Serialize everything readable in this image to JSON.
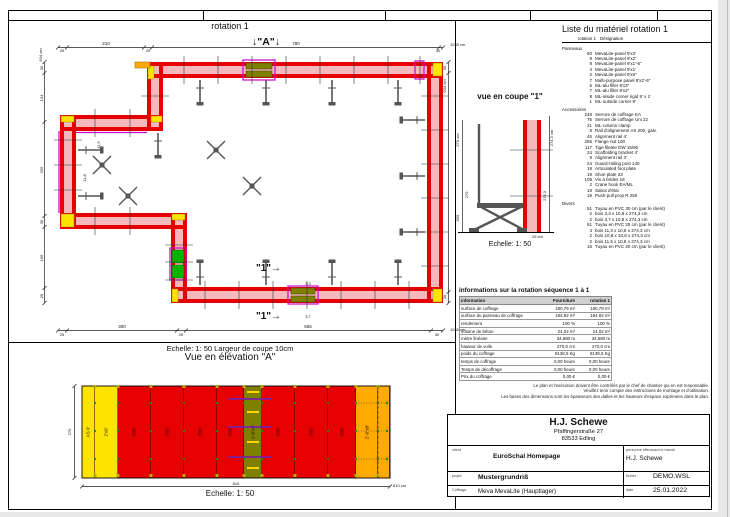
{
  "plan": {
    "title": "rotation 1",
    "marker_a": "↓\"A\"↓",
    "marker_1": "\"1\"→",
    "dims_top": [
      "25",
      "210",
      "20",
      "780",
      "30"
    ],
    "dims_top_total": "1045 cm",
    "dims_bottom": [
      "25",
      "300",
      "25",
      "665",
      "30"
    ],
    "dims_bottom_total": "1045 cm",
    "dims_left": [
      "30",
      "134",
      "255",
      "30",
      "166",
      "25"
    ],
    "dims_left_total": "604 cm",
    "dims_right": [
      "30",
      "30"
    ],
    "dims_right_total": "604 cm",
    "fillers": [
      "11,5",
      "11,8",
      "3,3",
      "3,7"
    ],
    "scale_note": "Echelle: 1: 50   Largeur de coupe 10cm"
  },
  "elevation": {
    "title": "Vue en élévation \"A\"",
    "dim_height": "270",
    "dim_width": "810",
    "dim_width_total": "810 cm",
    "scale": "Echelle: 1: 50",
    "panels": [
      {
        "label": "AS 9'",
        "color": "#ffe400",
        "w": 13
      },
      {
        "label": "2'x9'",
        "color": "#ffe400",
        "w": 23
      },
      {
        "label": "3'x9'",
        "color": "#e60000",
        "w": 33
      },
      {
        "label": "3'x9'",
        "color": "#e60000",
        "w": 33
      },
      {
        "label": "3'x9'",
        "color": "#e60000",
        "w": 33
      },
      {
        "label": "3'x9'",
        "color": "#e60000",
        "w": 27
      },
      {
        "label": "1'-6\"x9'",
        "color": "#7f7f00",
        "w": 18
      },
      {
        "label": "3'x9'",
        "color": "#e60000",
        "w": 33
      },
      {
        "label": "3'x9'",
        "color": "#e60000",
        "w": 33
      },
      {
        "label": "3'x9'",
        "color": "#e60000",
        "w": 28
      },
      {
        "label": "2'-6\"x9'",
        "color": "#ffaa00",
        "w": 22
      },
      {
        "label": "",
        "color": "#ffaa00",
        "w": 12
      }
    ]
  },
  "section": {
    "title": "vue en coupe \"1\"",
    "dim_left_cm": "270 cm",
    "dim_left": "270",
    "dim_left2": "609",
    "dim_right_cm": "274,3 cm",
    "dim_right": "274,3",
    "dim_bottom": "25 cm",
    "scale": "Echelle: 1: 50"
  },
  "material_list": {
    "title": "Liste du matériel  rotation 1",
    "col_qty": "rotation 1",
    "col_name": "Désignation",
    "groups": [
      {
        "name": "Panneaux",
        "items": [
          {
            "qty": "50",
            "name": "MevaLite-panel 9'x3'"
          },
          {
            "qty": "9",
            "name": "MevaLite-panel 9'x2'"
          },
          {
            "qty": "8",
            "name": "MevaLite-panel 9'x1'-6\""
          },
          {
            "qty": "4",
            "name": "MevaLite-panel 9'x1'"
          },
          {
            "qty": "2",
            "name": "MevaLite-panel 9'x6\""
          },
          {
            "qty": "7",
            "name": "Multi-purpose panel 9'x2'-6\""
          },
          {
            "qty": "5",
            "name": "ML-alu filler 9'x3\""
          },
          {
            "qty": "7",
            "name": "ML-alu filler 9'x2\""
          },
          {
            "qty": "8",
            "name": "ML-inside corner rigid 9' x 1'"
          },
          {
            "qty": "1",
            "name": "ML-outside corner 9'"
          }
        ]
      },
      {
        "name": "Accessoires",
        "items": [
          {
            "qty": "249",
            "name": "Serrure de coffrage EA"
          },
          {
            "qty": "75",
            "name": "Serrure de coffrage Uni 22"
          },
          {
            "qty": "21",
            "name": "ML-column clamp"
          },
          {
            "qty": "8",
            "name": "Rail d'alignement AS 200, galv."
          },
          {
            "qty": "45",
            "name": "Alignment rail 4'"
          },
          {
            "qty": "255",
            "name": "Flange nut 100"
          },
          {
            "qty": "117",
            "name": "Tige filetée DW 15/90"
          },
          {
            "qty": "24",
            "name": "Scaffolding bracket 4'"
          },
          {
            "qty": "9",
            "name": "Alignment rail 3'"
          },
          {
            "qty": "24",
            "name": "Guard-railing post 140"
          },
          {
            "qty": "19",
            "name": "Articulated foot plate"
          },
          {
            "qty": "19",
            "name": "Shoe plate 23"
          },
          {
            "qty": "109",
            "name": "Vis à brides 18"
          },
          {
            "qty": "2",
            "name": "Crane hook EA/ML"
          },
          {
            "qty": "19",
            "name": "Sabot d'étai"
          },
          {
            "qty": "19",
            "name": "Push-pull prop R 250"
          }
        ]
      },
      {
        "name": "Divers",
        "items": [
          {
            "qty": "51",
            "name": "Tuyau en PVC 30 cm (par le client)"
          },
          {
            "qty": "2",
            "name": "bois 3,3 x 10,8 x 274,3 cm"
          },
          {
            "qty": "2",
            "name": "bois 3,7 x 10,8 x 274,3 cm"
          },
          {
            "qty": "51",
            "name": "Tuyau en PVC 25 cm (par le client)"
          },
          {
            "qty": "4",
            "name": "bois 11,3 x 10,8 x 274,3 cm"
          },
          {
            "qty": "2",
            "name": "bois 10,8 x 10,8 x 274,3 cm"
          },
          {
            "qty": "2",
            "name": "bois 11,5 x 10,8 x 274,3 cm"
          },
          {
            "qty": "16",
            "name": "Tuyau en PVC 20 cm (par le client)"
          }
        ]
      }
    ]
  },
  "info_table": {
    "title": "informations sur la rotation  séquence 1 à 1",
    "headers": [
      "information",
      "Fourniture",
      "rotation 1"
    ],
    "rows": [
      [
        "surface de coffrage",
        "180,79 m²",
        "180,79 m²"
      ],
      [
        "surface du panneau de coffrage",
        "184,92 m²",
        "184,92 m²"
      ],
      [
        "rendement",
        "100 %",
        "100 %"
      ],
      [
        "volume de béton",
        "24,02 m³",
        "24,02 m³"
      ],
      [
        "mètre linéaire",
        "34,580 m",
        "34,580 m"
      ],
      [
        "hauteur de voile",
        "270,0 cm",
        "270,0 cm"
      ],
      [
        "poids du coffrage",
        "8138,5 Kg",
        "8138,5 Kg"
      ],
      [
        "temps de coffrage",
        "0,00 heure",
        "0,00 heure"
      ],
      [
        "Temps de décoffrage",
        "0,00 heure",
        "0,00 heure"
      ],
      [
        "Prix du coffrage",
        "0,00 €",
        "0,00 €"
      ]
    ]
  },
  "disclaimer": {
    "lines": [
      "Le plan et l'exécution doivent être contrôlés par le chef de chantier qui en est responsable.",
      "Veuillez tenir compte des instructions de montage et d'utilisation.",
      "Les bases des dimensions sont les épaisseurs des dalles et les hauteurs d'espace exprimées dans le plan."
    ]
  },
  "title_block": {
    "company": "H.J. Schewe",
    "address1": "Pfaffingerstraße 27",
    "address2": "83533 Edling",
    "client_label": "client",
    "client": "EuroSchal Homepage",
    "worker_label": "personne effectuant le travail",
    "worker": "H.J. Schewe",
    "project_label": "projet",
    "project": "Mustergrundriß",
    "file_label": "fichier",
    "file": "DEMO.WSL",
    "formwork_label": "Coffrage",
    "formwork": "Meva MevaLite (Hauptlager)",
    "date_label": "date",
    "date": "25.01.2022"
  },
  "colors": {
    "panel_red": "#e60000",
    "concrete_pink": "#f5b9bd",
    "corner_yellow": "#ffe400",
    "outside_corner_orange": "#ffaa00",
    "filler_olive": "#7f7f00",
    "accent_magenta": "#cc00cc",
    "panel_green": "#00b400",
    "prop_gray": "#555555"
  }
}
